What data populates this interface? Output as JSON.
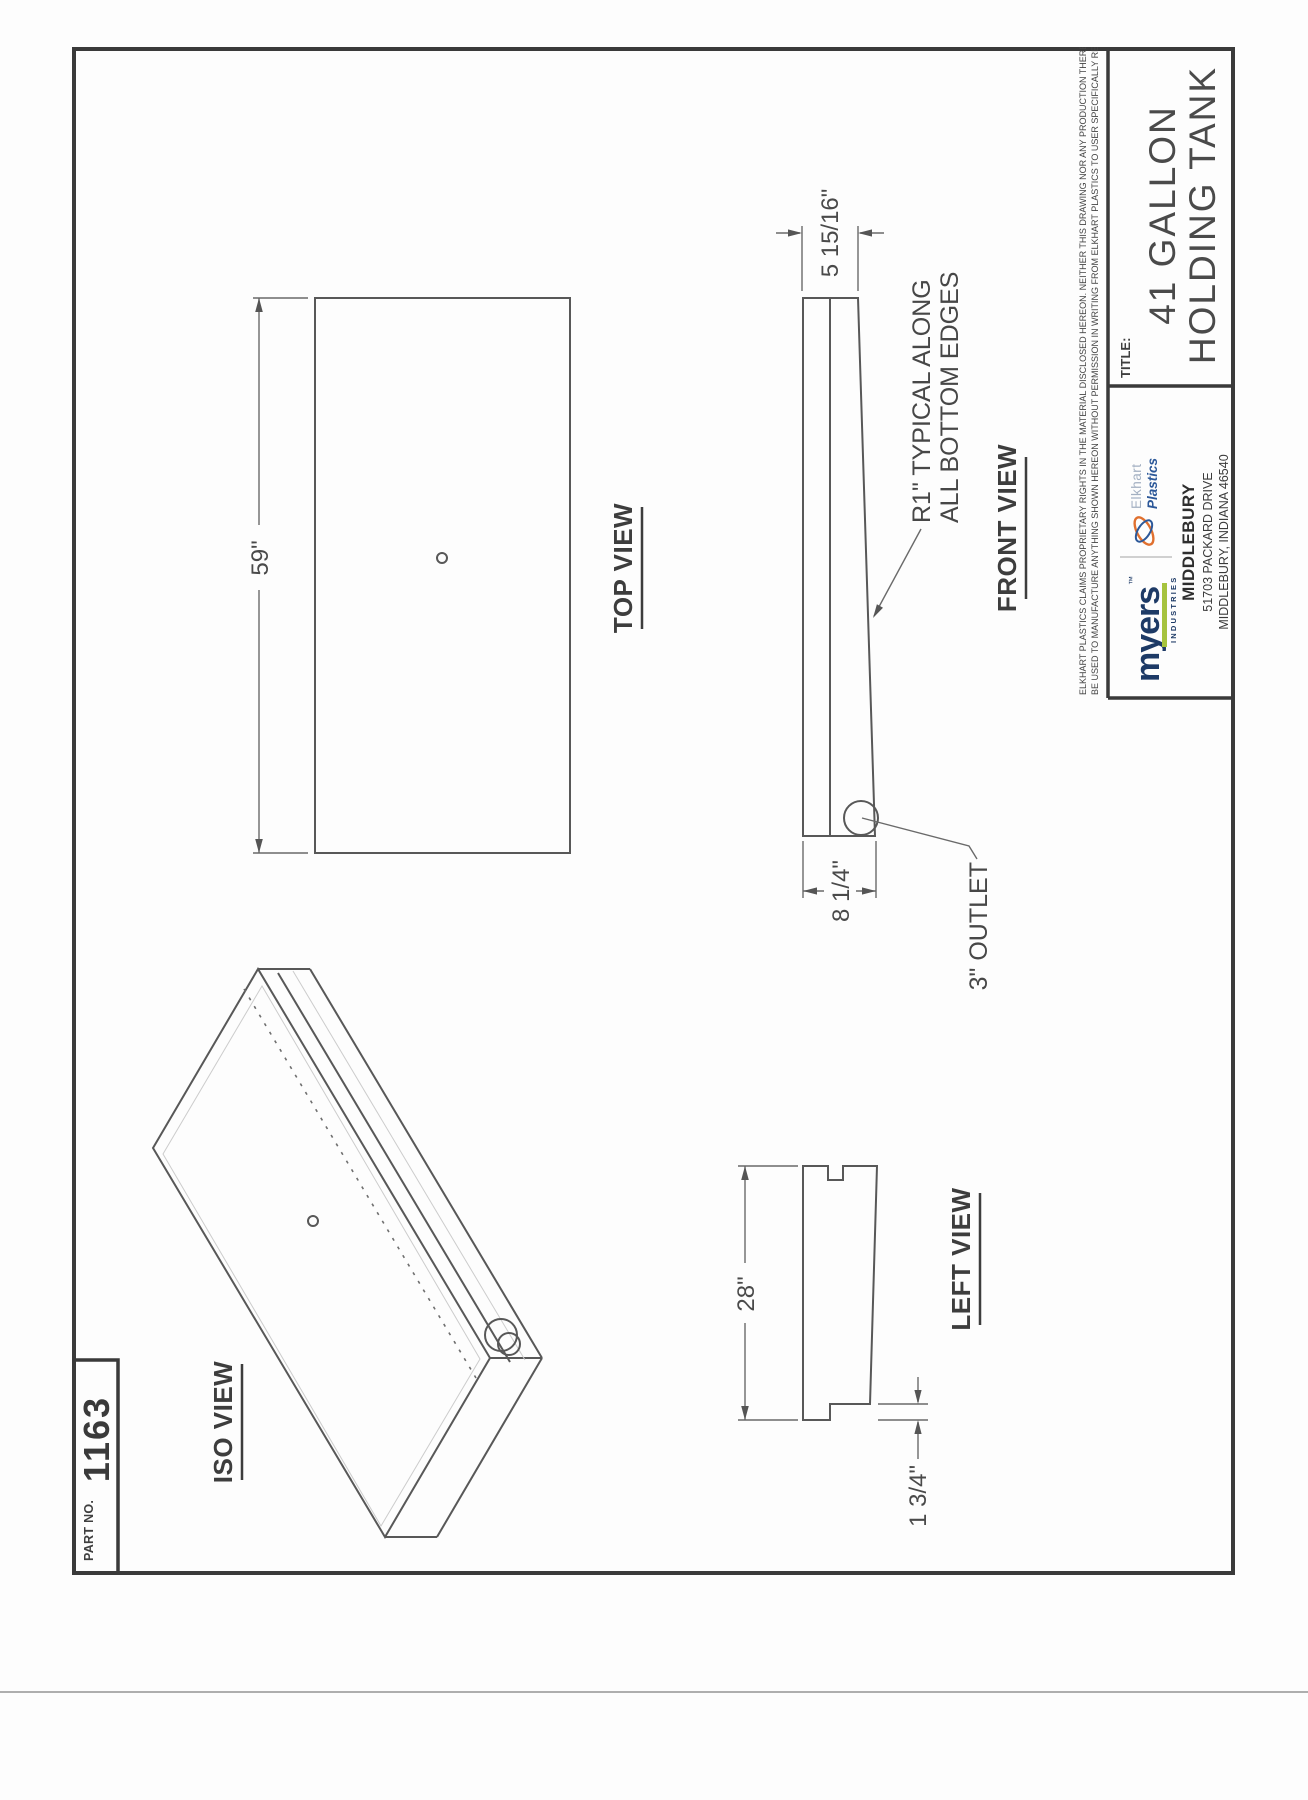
{
  "part_no": {
    "label": "PART NO.",
    "value": "1163"
  },
  "views": {
    "iso_label": "ISO VIEW",
    "top_label": "TOP VIEW",
    "front_label": "FRONT VIEW",
    "left_label": "LEFT VIEW"
  },
  "dims": {
    "length": "59\"",
    "width": "28\"",
    "end_height_large": "8 1/4\"",
    "end_height_small": "5 15/16\"",
    "lip_height": "1 3/4\""
  },
  "notes": {
    "radius_line1": "R1\" TYPICAL ALONG",
    "radius_line2": "ALL BOTTOM EDGES",
    "outlet": "3\" OUTLET"
  },
  "title_block": {
    "title_label": "TITLE:",
    "title_line1": "41 GALLON",
    "title_line2": "HOLDING TANK",
    "disclaimer_line1": "ELKHART PLASTICS CLAIMS PROPRIETARY RIGHTS IN THE MATERIAL DISCLOSED HEREON. NEITHER THIS DRAWING NOR ANY PRODUCTION THEREOF MAY",
    "disclaimer_line2": "BE USED TO MANUFACTURE ANYTHING SHOWN HEREON WITHOUT PERMISSION IN WRITING FROM ELKHART PLASTICS TO USER SPECIFICALLY REFERRING TO THIS DRAWING.",
    "brand": {
      "name": "myers",
      "tm": "™",
      "sub": "INDUSTRIES",
      "partner_top": "Elkhart",
      "partner_bottom": "Plastics"
    },
    "facility": "MIDDLEBURY",
    "address_line1": "51703 PACKARD DRIVE",
    "address_line2": "MIDDLEBURY, INDIANA 46540"
  },
  "colors": {
    "line": "#585858",
    "text": "#3f3f3f",
    "frame": "#3a3a3a",
    "myers_navy": "#1d3a66",
    "myers_green": "#a6c33e",
    "elkhart_blue": "#2c5899",
    "elkhart_gray": "#a3b0c2",
    "elkhart_orange": "#e0702f"
  }
}
